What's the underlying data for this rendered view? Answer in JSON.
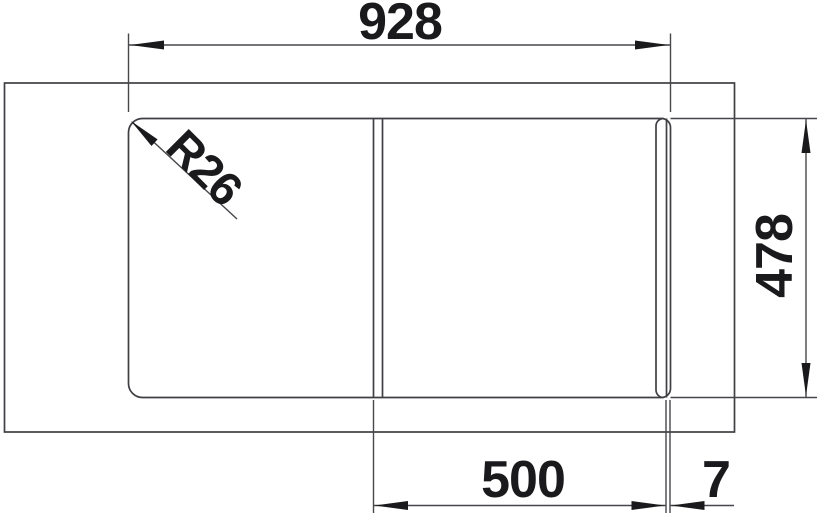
{
  "drawing": {
    "kind": "sink-top-view-technical-drawing",
    "labels": {
      "overall_width": "928",
      "depth": "478",
      "bowl_width": "500",
      "edge_gap": "7",
      "corner_radius": "R26"
    },
    "style": {
      "background": "#ffffff",
      "line_color": "#3f3f44",
      "dim_line_color": "#46464b",
      "text_color": "#1a1a1c"
    }
  }
}
